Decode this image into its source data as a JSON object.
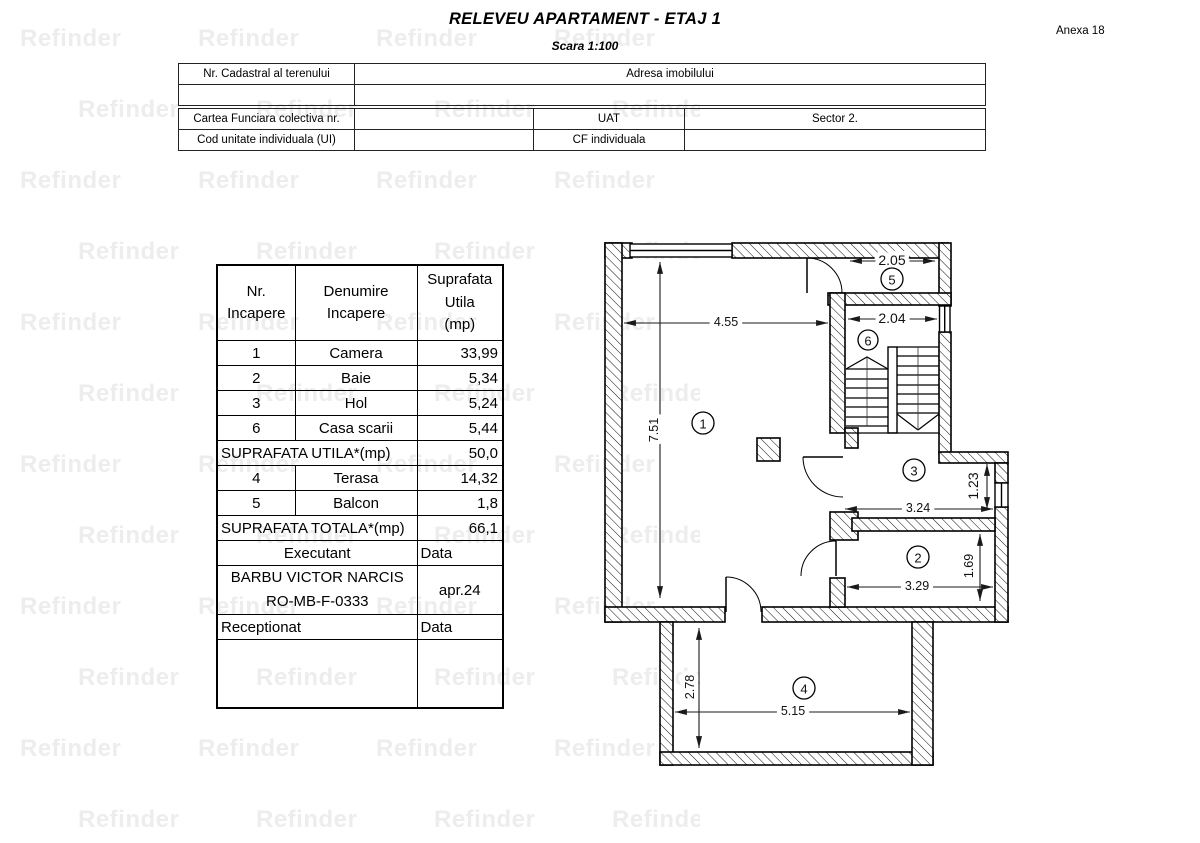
{
  "page": {
    "title": "RELEVEU APARTAMENT - ETAJ 1",
    "subtitle": "Scara 1:100",
    "annex": "Anexa 18",
    "watermark": "Refinder"
  },
  "info_table": {
    "nr_cadastral_label": "Nr. Cadastral al terenului",
    "adresa_label": "Adresa imobilului",
    "cartea_funciara_label": "Cartea Funciara colectiva nr.",
    "uat_label": "UAT",
    "uat_value": "Sector 2.",
    "cod_unitate_label": "Cod unitate individuala (UI)",
    "cf_individuala_label": "CF individuala"
  },
  "room_table": {
    "headers": {
      "col1": "Nr.\nIncapere",
      "col2": "Denumire\nIncapere",
      "col3": "Suprafata\nUtila\n(mp)"
    },
    "rooms": [
      {
        "nr": "1",
        "name": "Camera",
        "area": "33,99"
      },
      {
        "nr": "2",
        "name": "Baie",
        "area": "5,34"
      },
      {
        "nr": "3",
        "name": "Hol",
        "area": "5,24"
      },
      {
        "nr": "6",
        "name": "Casa scarii",
        "area": "5,44"
      }
    ],
    "subtotal_label": "SUPRAFATA UTILA*(mp)",
    "subtotal_value": "50,0",
    "annex_rooms": [
      {
        "nr": "4",
        "name": "Terasa",
        "area": "14,32"
      },
      {
        "nr": "5",
        "name": "Balcon",
        "area": "1,8"
      }
    ],
    "total_label": "SUPRAFATA TOTALA*(mp)",
    "total_value": "66,1",
    "executant_label": "Executant",
    "executant_data_label": "Data",
    "executant_name": "BARBU  VICTOR NARCIS",
    "executant_code": "RO-MB-F-0333",
    "executant_date": "apr.24",
    "receptionat_label": "Receptionat",
    "receptionat_data_label": "Data"
  },
  "plan": {
    "rooms": {
      "r1": "1",
      "r2": "2",
      "r3": "3",
      "r4": "4",
      "r5": "5",
      "r6": "6"
    },
    "dims": {
      "w_room1": "4.55",
      "h_room1": "7.51",
      "w_balcony": "2.05",
      "w_stairs": "2.04",
      "w_hall": "3.24",
      "h_hall": "1.23",
      "w_bath": "3.29",
      "h_bath": "1.69",
      "w_terrace": "5.15",
      "h_terrace": "2.78"
    }
  }
}
